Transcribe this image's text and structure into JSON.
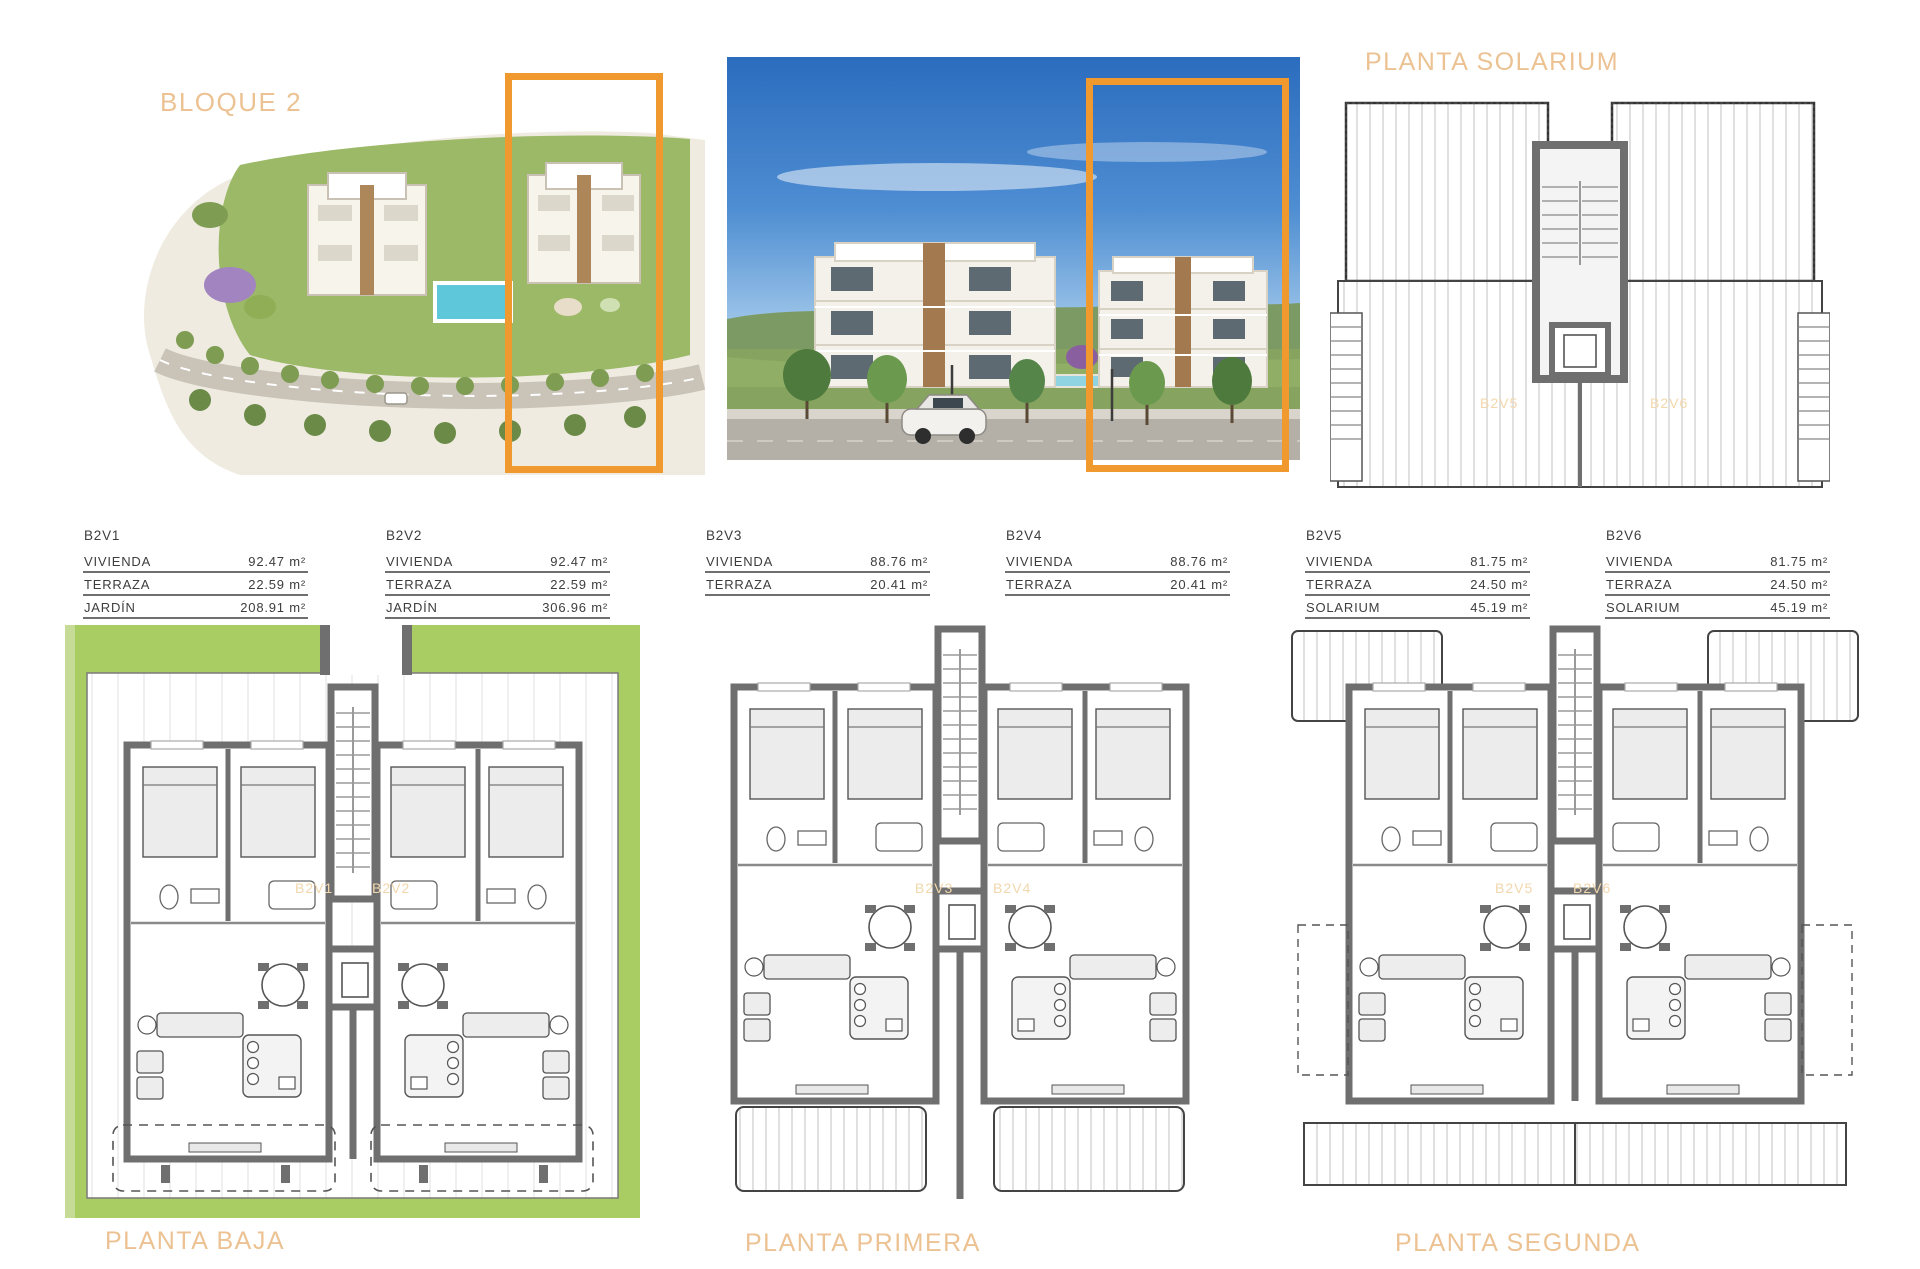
{
  "header": {
    "bloque_title": "BLOQUE 2",
    "solarium_title": "PLANTA SOLARIUM"
  },
  "colors": {
    "accent_orange": "#F0992E",
    "title_orange": "#ECC293",
    "faint_label_orange": "#F2D7AC",
    "garden_green": "#A9CD62",
    "wall_gray": "#6F6F6F"
  },
  "units": [
    {
      "id": "B2V1",
      "rows": [
        {
          "label": "VIVIENDA",
          "value": "92.47 m²"
        },
        {
          "label": "TERRAZA",
          "value": "22.59 m²"
        },
        {
          "label": "JARDÍN",
          "value": "208.91 m²"
        }
      ]
    },
    {
      "id": "B2V2",
      "rows": [
        {
          "label": "VIVIENDA",
          "value": "92.47 m²"
        },
        {
          "label": "TERRAZA",
          "value": "22.59 m²"
        },
        {
          "label": "JARDÍN",
          "value": "306.96 m²"
        }
      ]
    },
    {
      "id": "B2V3",
      "rows": [
        {
          "label": "VIVIENDA",
          "value": "88.76 m²"
        },
        {
          "label": "TERRAZA",
          "value": "20.41 m²"
        }
      ]
    },
    {
      "id": "B2V4",
      "rows": [
        {
          "label": "VIVIENDA",
          "value": "88.76 m²"
        },
        {
          "label": "TERRAZA",
          "value": "20.41 m²"
        }
      ]
    },
    {
      "id": "B2V5",
      "rows": [
        {
          "label": "VIVIENDA",
          "value": "81.75 m²"
        },
        {
          "label": "TERRAZA",
          "value": "24.50 m²"
        },
        {
          "label": "SOLARIUM",
          "value": "45.19 m²"
        }
      ]
    },
    {
      "id": "B2V6",
      "rows": [
        {
          "label": "VIVIENDA",
          "value": "81.75 m²"
        },
        {
          "label": "TERRAZA",
          "value": "24.50 m²"
        },
        {
          "label": "SOLARIUM",
          "value": "45.19 m²"
        }
      ]
    }
  ],
  "plans": {
    "solarium": {
      "title": "PLANTA SOLARIUM",
      "label_left": "B2V5",
      "label_right": "B2V6"
    },
    "baja": {
      "title": "PLANTA BAJA",
      "label_left": "B2V1",
      "label_right": "B2V2"
    },
    "primera": {
      "title": "PLANTA PRIMERA",
      "label_left": "B2V3",
      "label_right": "B2V4"
    },
    "segunda": {
      "title": "PLANTA SEGUNDA",
      "label_left": "B2V5",
      "label_right": "B2V6"
    }
  }
}
